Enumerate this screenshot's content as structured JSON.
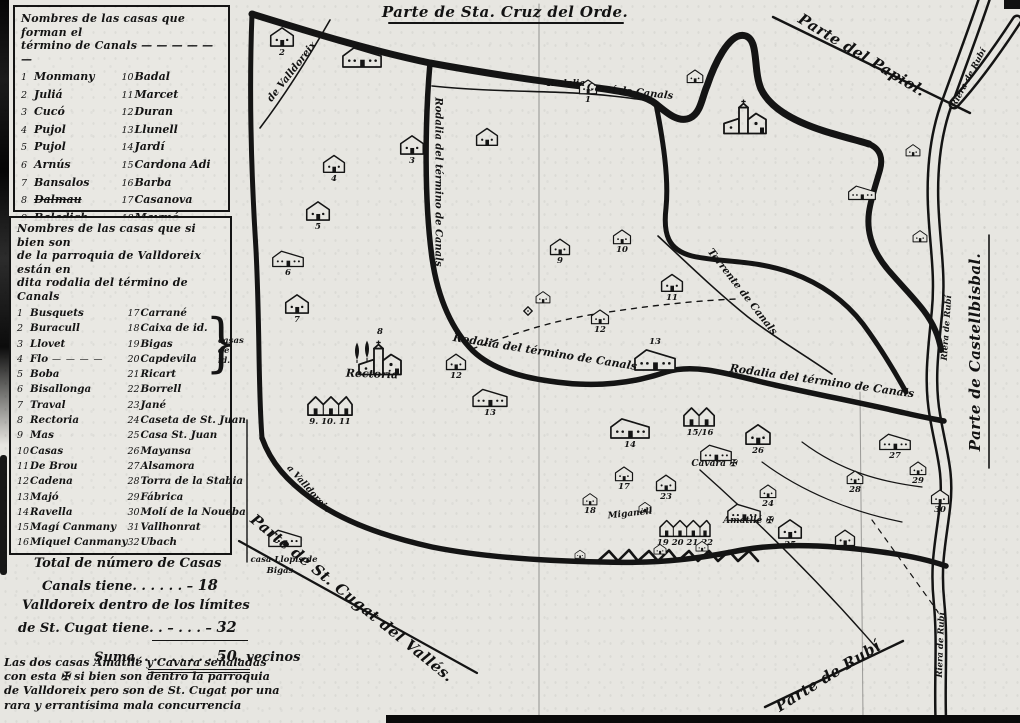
{
  "legend_canals": {
    "title_line1": "Nombres de las casas que forman el",
    "title_line2": "término de Canals — — — — — —",
    "left": [
      {
        "n": "1",
        "name": "Monmany"
      },
      {
        "n": "2",
        "name": "Juliá"
      },
      {
        "n": "3",
        "name": "Cucó"
      },
      {
        "n": "4",
        "name": "Pujol"
      },
      {
        "n": "5",
        "name": "Pujol"
      },
      {
        "n": "6",
        "name": "Arnús"
      },
      {
        "n": "7",
        "name": "Bansalos"
      },
      {
        "n": "8",
        "name": "Dalmau",
        "strike": true
      },
      {
        "n": "9",
        "name": "Baladich"
      }
    ],
    "right": [
      {
        "n": "10",
        "name": "Badal"
      },
      {
        "n": "11",
        "name": "Marcet"
      },
      {
        "n": "12",
        "name": "Duran"
      },
      {
        "n": "13",
        "name": "Llunell"
      },
      {
        "n": "14",
        "name": "Jardí"
      },
      {
        "n": "15",
        "name": "Cardona Adi"
      },
      {
        "n": "16",
        "name": "Barba"
      },
      {
        "n": "17",
        "name": "Casanova"
      },
      {
        "n": "18",
        "name": "Maymó"
      }
    ]
  },
  "legend_valldoreix": {
    "title_line1": "Nombres de las casas que si bien son",
    "title_line2": "de la parroquia de Valldoreix están en",
    "title_line3": "dita rodalia del término de Canals",
    "left": [
      {
        "n": "1",
        "name": "Busquets"
      },
      {
        "n": "2",
        "name": "Buracull"
      },
      {
        "n": "3",
        "name": "Llovet"
      },
      {
        "n": "4",
        "name": "Flo",
        "suffix": " — — — —"
      },
      {
        "n": "5",
        "name": "Boba"
      },
      {
        "n": "6",
        "name": "Bisallonga"
      },
      {
        "n": "7",
        "name": "Traval"
      },
      {
        "n": "8",
        "name": "Rectoria"
      },
      {
        "n": "9",
        "name": "Mas"
      },
      {
        "n": "10",
        "name": "Casas"
      },
      {
        "n": "11",
        "name": "De Brou"
      },
      {
        "n": "12",
        "name": "Cadena"
      },
      {
        "n": "13",
        "name": "Majó"
      },
      {
        "n": "14",
        "name": "Ravella"
      },
      {
        "n": "15",
        "name": "Magí Canmany"
      },
      {
        "n": "16",
        "name": "Miquel Canmany"
      }
    ],
    "right": [
      {
        "n": "17",
        "name": "Carrané"
      },
      {
        "n": "18",
        "name": "Caixa de id."
      },
      {
        "n": "19",
        "name": "Bigas"
      },
      {
        "n": "20",
        "name": "Capdevila"
      },
      {
        "n": "21",
        "name": "Ricart"
      },
      {
        "n": "22",
        "name": "Borrell"
      },
      {
        "n": "23",
        "name": "Jané"
      },
      {
        "n": "24",
        "name": "Caseta de St. Juan"
      },
      {
        "n": "25",
        "name": "Casa St. Juan"
      },
      {
        "n": "26",
        "name": "Mayansa"
      },
      {
        "n": "27",
        "name": "Alsamora"
      },
      {
        "n": "28",
        "name": "Torra de la Stabia"
      },
      {
        "n": "29",
        "name": "Fábrica"
      },
      {
        "n": "30",
        "name": "Molí de la Noueba"
      },
      {
        "n": "31",
        "name": "Vallhonrat"
      },
      {
        "n": "32",
        "name": "Ubach"
      }
    ],
    "brace_label_1": "casas",
    "brace_label_2": "de id."
  },
  "totals": {
    "line1": "Total de número de Casas",
    "line2_label": "Canals tiene",
    "line2_dots": ". . . . . . –",
    "line2_value": "18",
    "line3": "Valldoreix dentro de los límites",
    "line4_label": "de St. Cugat tiene",
    "line4_dots": ". . – . . . –",
    "line4_value": "32",
    "suma_label": "Suma",
    "suma_dots": ". . . . . . . . .",
    "suma_value": "50.",
    "suma_unit": "vecinos"
  },
  "footnote": {
    "lines": [
      "Las dos casas Amatllé y Cavara señaladas",
      "con esta ✠ si bien son dentro la parroquia",
      "de Valldoreix pero son de St. Cugat por una",
      "rara y errantísima mala concurrencia"
    ]
  },
  "map_labels": [
    {
      "text": "Parte de Sta. Cruz del Orde.",
      "x": 505,
      "y": 12,
      "rot": 0,
      "size": 15,
      "name": "label-parte-sta-cruz-del-orde"
    },
    {
      "text": "Parte del Papiol.",
      "x": 862,
      "y": 55,
      "rot": 31,
      "size": 15,
      "name": "label-parte-del-papiol"
    },
    {
      "text": "Parte de Castellbisbal.",
      "x": 975,
      "y": 352,
      "rot": -90,
      "size": 15,
      "name": "label-parte-de-castellbisbal"
    },
    {
      "text": "Parte de St. Cugat del Vallés.",
      "x": 352,
      "y": 598,
      "rot": 39,
      "size": 15,
      "name": "label-parte-de-st-cugat"
    },
    {
      "text": "Parte de Rubí",
      "x": 828,
      "y": 676,
      "rot": -32,
      "size": 15,
      "name": "label-parte-de-rubi"
    },
    {
      "text": "Riera de Rubí",
      "x": 969,
      "y": 78,
      "rot": -62,
      "size": 8.5,
      "name": "label-riera-de-rubi"
    },
    {
      "text": "Riera de Rubí",
      "x": 947,
      "y": 328,
      "rot": -86,
      "size": 8.5,
      "name": "label-riera-de-rubi"
    },
    {
      "text": "Riera de Rubí",
      "x": 941,
      "y": 645,
      "rot": -88,
      "size": 8.5,
      "name": "label-riera-de-rubi"
    },
    {
      "text": "Rodalia del término de Canals",
      "x": 438,
      "y": 182,
      "rot": 90,
      "size": 10,
      "name": "label-rodalia-oeste"
    },
    {
      "text": "Rodalia del término de Canals",
      "x": 545,
      "y": 352,
      "rot": 9,
      "size": 11,
      "name": "label-rodalia-centro"
    },
    {
      "text": "Rodalia del término de Canals",
      "x": 822,
      "y": 381,
      "rot": 8,
      "size": 11,
      "name": "label-rodalia-sureste"
    },
    {
      "text": "Torrente de Canals",
      "x": 742,
      "y": 292,
      "rot": 52,
      "size": 10,
      "name": "label-torrente-de-canals"
    },
    {
      "text": "Camí de Canals",
      "x": 630,
      "y": 92,
      "rot": 6,
      "size": 10,
      "name": "label-cami-de-canals"
    },
    {
      "text": "Rodalia",
      "x": 566,
      "y": 84,
      "rot": 0,
      "size": 9,
      "name": "label-rodalia-norte"
    },
    {
      "text": "de Valldoreix",
      "x": 292,
      "y": 72,
      "rot": -52,
      "size": 10,
      "name": "label-cami-valldoreix"
    },
    {
      "text": "a Valldoreix",
      "x": 308,
      "y": 489,
      "rot": 48,
      "size": 9,
      "name": "label-a-valldoreix"
    },
    {
      "text": "Rectoria",
      "x": 372,
      "y": 374,
      "rot": 2,
      "size": 11,
      "name": "label-rectoria"
    },
    {
      "text": "Cavara ✠",
      "x": 714,
      "y": 464,
      "rot": 0,
      "size": 9,
      "name": "label-casa-cavara"
    },
    {
      "text": "Amatllé ✠",
      "x": 748,
      "y": 521,
      "rot": 0,
      "size": 9,
      "name": "label-casa-amatlle"
    },
    {
      "text": "Miganell",
      "x": 630,
      "y": 514,
      "rot": -6,
      "size": 9,
      "name": "label-miganell"
    },
    {
      "text": "casa Llopis de",
      "x": 284,
      "y": 560,
      "rot": 0,
      "size": 8.5,
      "name": "label-casa-llopis-1"
    },
    {
      "text": "Bigas",
      "x": 280,
      "y": 571,
      "rot": 0,
      "size": 8.5,
      "name": "label-casa-llopis-2"
    }
  ],
  "houses": [
    {
      "x": 282,
      "y": 36,
      "t": "h",
      "s": 26,
      "l": "2"
    },
    {
      "x": 362,
      "y": 57,
      "t": "w",
      "s": 40,
      "l": ""
    },
    {
      "x": 588,
      "y": 86,
      "t": "h",
      "s": 20,
      "l": "1"
    },
    {
      "x": 695,
      "y": 76,
      "t": "h",
      "s": 18,
      "l": ""
    },
    {
      "x": 745,
      "y": 118,
      "t": "c",
      "s": 46,
      "l": ""
    },
    {
      "x": 412,
      "y": 144,
      "t": "h",
      "s": 26,
      "l": "3"
    },
    {
      "x": 487,
      "y": 136,
      "t": "h",
      "s": 24,
      "l": ""
    },
    {
      "x": 334,
      "y": 163,
      "t": "h",
      "s": 24,
      "l": "4"
    },
    {
      "x": 318,
      "y": 210,
      "t": "h",
      "s": 26,
      "l": "5"
    },
    {
      "x": 288,
      "y": 258,
      "t": "w",
      "s": 32,
      "l": "6"
    },
    {
      "x": 297,
      "y": 303,
      "t": "h",
      "s": 26,
      "l": "7"
    },
    {
      "x": 913,
      "y": 150,
      "t": "h",
      "s": 16,
      "l": ""
    },
    {
      "x": 862,
      "y": 192,
      "t": "w",
      "s": 28,
      "l": ""
    },
    {
      "x": 920,
      "y": 236,
      "t": "h",
      "s": 16,
      "l": ""
    },
    {
      "x": 560,
      "y": 246,
      "t": "h",
      "s": 22,
      "l": "9"
    },
    {
      "x": 622,
      "y": 236,
      "t": "h",
      "s": 20,
      "l": "10"
    },
    {
      "x": 672,
      "y": 282,
      "t": "h",
      "s": 24,
      "l": "11"
    },
    {
      "x": 543,
      "y": 297,
      "t": "h",
      "s": 16,
      "l": ""
    },
    {
      "x": 600,
      "y": 316,
      "t": "h",
      "s": 20,
      "l": "12"
    },
    {
      "x": 655,
      "y": 350,
      "t": "w",
      "s": 42,
      "l": "13",
      "lp": "t"
    },
    {
      "x": 380,
      "y": 350,
      "t": "c",
      "s": 46,
      "l": "8",
      "lp": "t"
    },
    {
      "x": 357,
      "y": 352,
      "t": "tree",
      "s": 8,
      "l": ""
    },
    {
      "x": 367,
      "y": 350,
      "t": "tree",
      "s": 8,
      "l": ""
    },
    {
      "x": 330,
      "y": 405,
      "t": "r3",
      "s": 46,
      "l": "9. 10. 11"
    },
    {
      "x": 456,
      "y": 361,
      "t": "h",
      "s": 22,
      "l": "12"
    },
    {
      "x": 528,
      "y": 311,
      "t": "diamond",
      "s": 10,
      "l": ""
    },
    {
      "x": 490,
      "y": 397,
      "t": "w",
      "s": 36,
      "l": "13"
    },
    {
      "x": 630,
      "y": 428,
      "t": "w",
      "s": 40,
      "l": "14"
    },
    {
      "x": 700,
      "y": 416,
      "t": "r2",
      "s": 34,
      "l": "15/16"
    },
    {
      "x": 758,
      "y": 434,
      "t": "h",
      "s": 28,
      "l": "26"
    },
    {
      "x": 716,
      "y": 452,
      "t": "w",
      "s": 32,
      "l": ""
    },
    {
      "x": 624,
      "y": 473,
      "t": "h",
      "s": 20,
      "l": "17"
    },
    {
      "x": 666,
      "y": 482,
      "t": "h",
      "s": 22,
      "l": "23"
    },
    {
      "x": 590,
      "y": 499,
      "t": "h",
      "s": 16,
      "l": "18"
    },
    {
      "x": 645,
      "y": 507,
      "t": "h",
      "s": 14,
      "l": ""
    },
    {
      "x": 685,
      "y": 528,
      "t": "r4",
      "s": 52,
      "l": "19 20 21 22"
    },
    {
      "x": 744,
      "y": 512,
      "t": "w",
      "s": 34,
      "l": ""
    },
    {
      "x": 790,
      "y": 528,
      "t": "h",
      "s": 26,
      "l": "25"
    },
    {
      "x": 768,
      "y": 491,
      "t": "h",
      "s": 18,
      "l": "24"
    },
    {
      "x": 845,
      "y": 537,
      "t": "h",
      "s": 22,
      "l": ""
    },
    {
      "x": 895,
      "y": 441,
      "t": "w",
      "s": 32,
      "l": "27"
    },
    {
      "x": 855,
      "y": 477,
      "t": "h",
      "s": 18,
      "l": "28"
    },
    {
      "x": 918,
      "y": 468,
      "t": "h",
      "s": 18,
      "l": "29"
    },
    {
      "x": 940,
      "y": 496,
      "t": "h",
      "s": 20,
      "l": "30"
    },
    {
      "x": 285,
      "y": 538,
      "t": "w",
      "s": 34,
      "l": ""
    },
    {
      "x": 660,
      "y": 549,
      "t": "h",
      "s": 14,
      "l": ""
    },
    {
      "x": 702,
      "y": 546,
      "t": "h",
      "s": 14,
      "l": ""
    },
    {
      "x": 580,
      "y": 554,
      "t": "h",
      "s": 12,
      "l": ""
    }
  ]
}
